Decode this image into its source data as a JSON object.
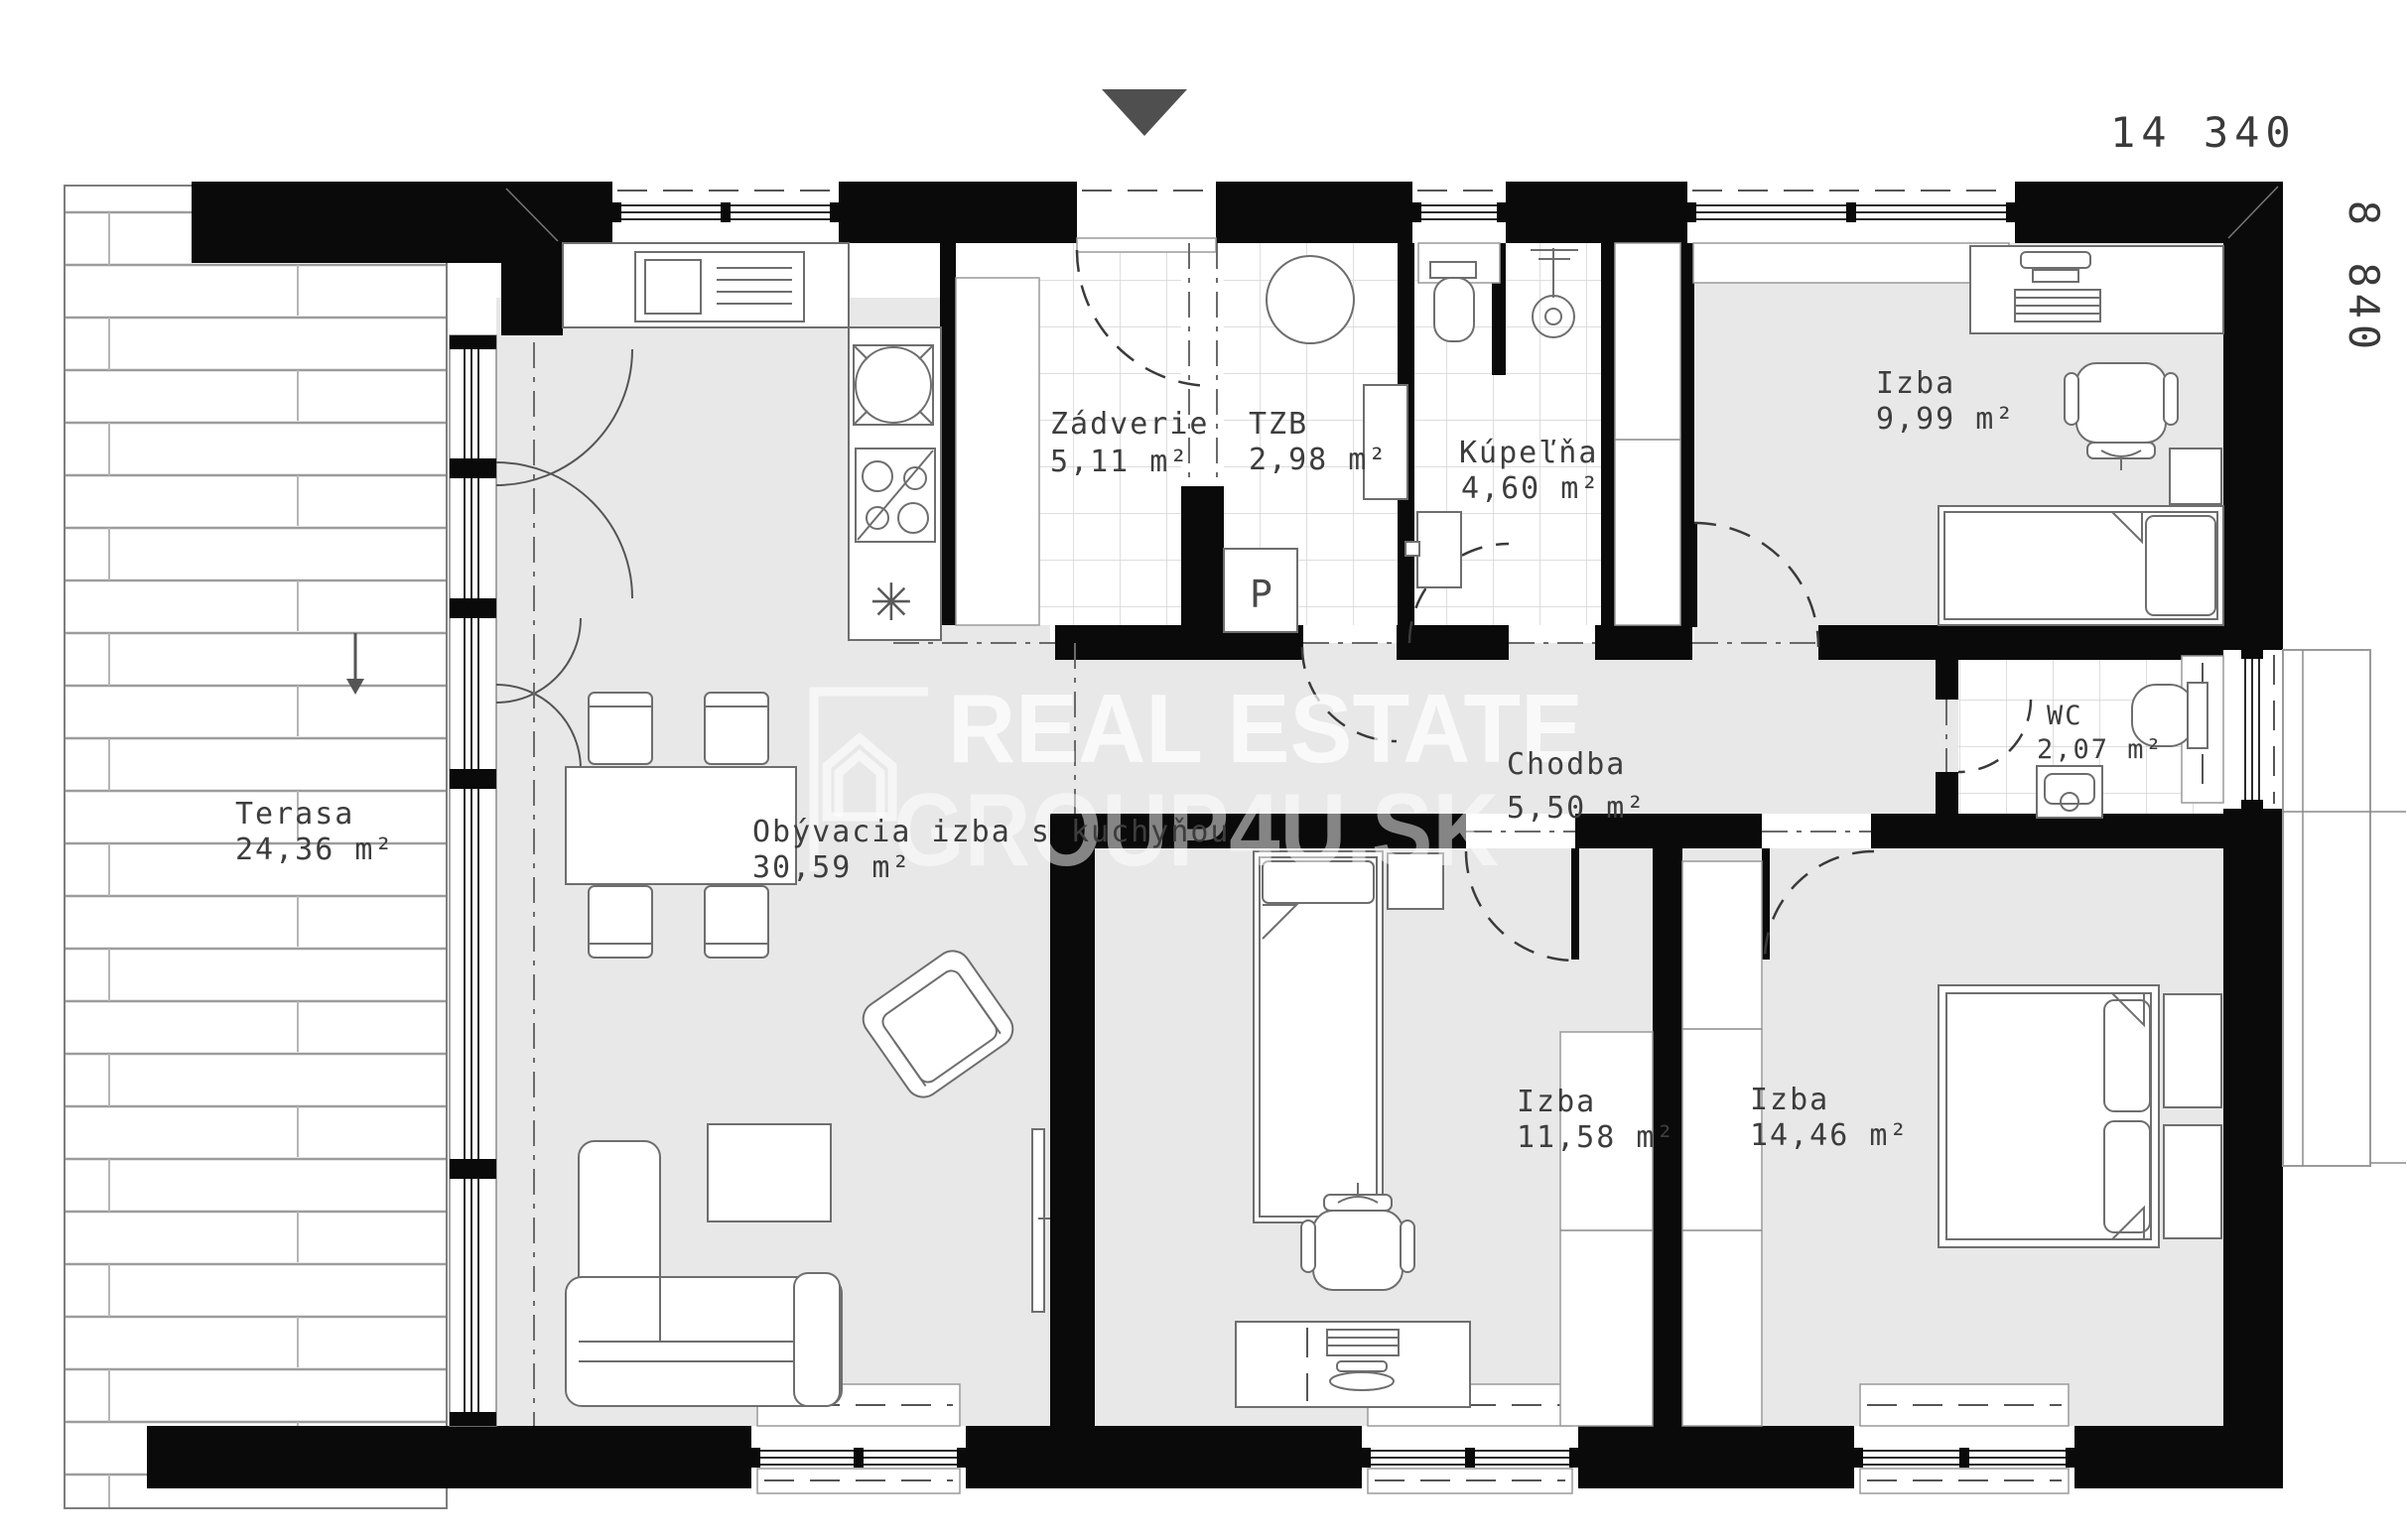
{
  "dimensions": {
    "width_label": "14 340",
    "height_label": "8 840"
  },
  "watermark": {
    "line1": "REAL ESTATE",
    "line2": "GROUP4U.SK",
    "logo": "house-outline"
  },
  "icons": {
    "entrance_marker": "triangle-down",
    "terrace_step_arrow": "arrow-down"
  },
  "rooms": [
    {
      "id": "terasa",
      "name": "Terasa",
      "area": "24,36 m²"
    },
    {
      "id": "obyvacia",
      "name": "Obývacia izba s kuchyňou",
      "area": "30,59 m²"
    },
    {
      "id": "zadverie",
      "name": "Zádverie",
      "area": "5,11 m²"
    },
    {
      "id": "tzb",
      "name": "TZB",
      "area": "2,98 m²"
    },
    {
      "id": "kupelna",
      "name": "Kúpeľňa",
      "area": "4,60 m²"
    },
    {
      "id": "chodba",
      "name": "Chodba",
      "area": "5,50 m²"
    },
    {
      "id": "izba1",
      "name": "Izba",
      "area": "9,99 m²"
    },
    {
      "id": "wc",
      "name": "WC",
      "area": "2,07 m²"
    },
    {
      "id": "izba2",
      "name": "Izba",
      "area": "11,58 m²"
    },
    {
      "id": "izba3",
      "name": "Izba",
      "area": "14,46 m²"
    }
  ],
  "labels": {
    "washing_machine": "P",
    "freezer_symbol": "✳"
  },
  "colors": {
    "wall": "#0a0a0a",
    "floor": "#e8e8e8",
    "tile_line": "#d4d4d4",
    "furniture_stroke": "#6e6e6e",
    "entrance_marker": "#4f4f4f",
    "dimension_text": "#3a3a3a"
  }
}
